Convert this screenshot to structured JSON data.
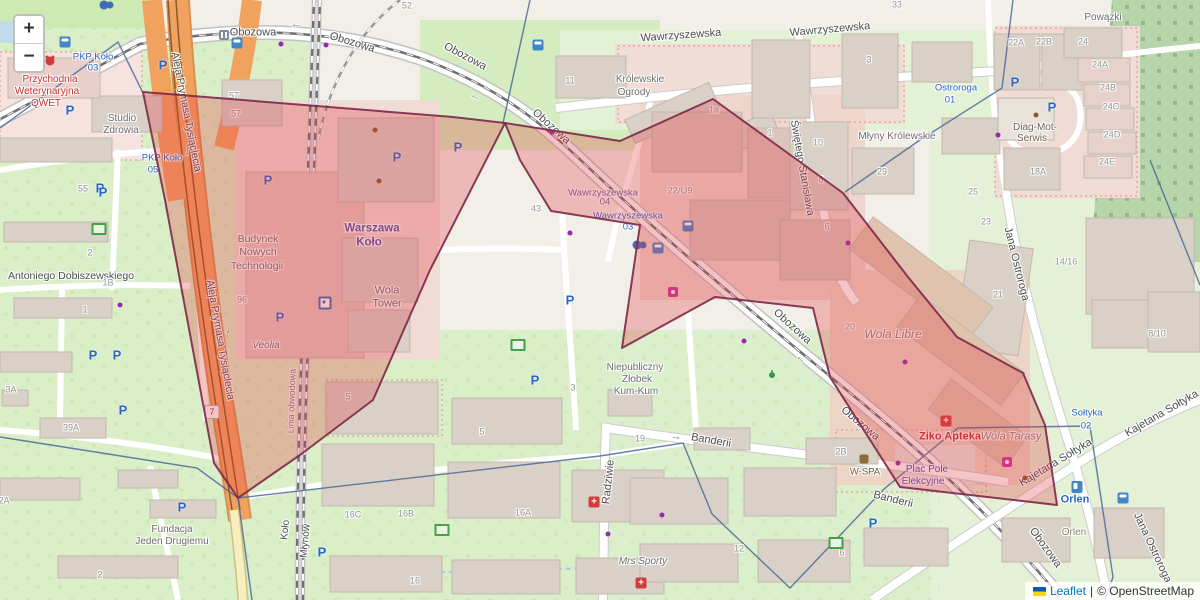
{
  "controls": {
    "zoom_in": "+",
    "zoom_out": "−"
  },
  "attribution": {
    "leaflet": "Leaflet",
    "sep": "|",
    "osm": "© OpenStreetMap"
  },
  "badge": {
    "t": "7",
    "x": 212,
    "y": 412
  },
  "overlay": {
    "fill": "#e23b42",
    "fill_opacity": 0.3,
    "stroke": "#7c2848",
    "stroke_width": 2,
    "stroke_opacity": 0.9,
    "polygons": [
      [
        [
          143,
          92
        ],
        [
          453,
          117
        ],
        [
          505,
          123
        ],
        [
          430,
          270
        ],
        [
          373,
          400
        ],
        [
          300,
          455
        ],
        [
          238,
          498
        ],
        [
          214,
          463
        ],
        [
          165,
          200
        ]
      ],
      [
        [
          505,
          123
        ],
        [
          620,
          141
        ],
        [
          713,
          99
        ],
        [
          843,
          193
        ],
        [
          908,
          277
        ],
        [
          957,
          337
        ],
        [
          1023,
          373
        ],
        [
          1045,
          425
        ],
        [
          1057,
          505
        ],
        [
          900,
          487
        ],
        [
          830,
          377
        ],
        [
          813,
          308
        ],
        [
          715,
          297
        ],
        [
          622,
          348
        ],
        [
          640,
          225
        ],
        [
          551,
          211
        ],
        [
          520,
          160
        ]
      ]
    ]
  },
  "admin_lines": {
    "color": "#4a6896",
    "width": 1.4,
    "paths": [
      [
        [
          0,
          128
        ],
        [
          118,
          42
        ],
        [
          143,
          93
        ]
      ],
      [
        [
          530,
          0
        ],
        [
          503,
          123
        ]
      ],
      [
        [
          0,
          437
        ],
        [
          197,
          468
        ],
        [
          238,
          498
        ],
        [
          600,
          456
        ],
        [
          683,
          443
        ],
        [
          712,
          514
        ],
        [
          790,
          588
        ],
        [
          884,
          489
        ],
        [
          958,
          428
        ],
        [
          1090,
          426
        ],
        [
          1113,
          577
        ],
        [
          1105,
          600
        ]
      ],
      [
        [
          238,
          498
        ],
        [
          252,
          600
        ]
      ],
      [
        [
          1013,
          0
        ],
        [
          1002,
          88
        ],
        [
          920,
          140
        ],
        [
          845,
          192
        ]
      ],
      [
        [
          1150,
          160
        ],
        [
          1200,
          285
        ]
      ]
    ]
  },
  "labels": [
    {
      "k": "st",
      "t": "Obozowa",
      "x": 253,
      "y": 33,
      "r": 0
    },
    {
      "k": "st",
      "t": "Obozowa",
      "x": 352,
      "y": 43,
      "r": 17
    },
    {
      "k": "st",
      "t": "Obozowa",
      "x": 465,
      "y": 57,
      "r": 28
    },
    {
      "k": "st",
      "t": "Obozowa",
      "x": 551,
      "y": 127,
      "r": 42
    },
    {
      "k": "st",
      "t": "Obozowa",
      "x": 792,
      "y": 327,
      "r": 42
    },
    {
      "k": "st",
      "t": "Obozowa",
      "x": 860,
      "y": 424,
      "r": 40
    },
    {
      "k": "st",
      "t": "Obozowa",
      "x": 1045,
      "y": 548,
      "r": 54
    },
    {
      "k": "st",
      "t": "Wawrzyszewska",
      "x": 681,
      "y": 36,
      "r": -4
    },
    {
      "k": "st",
      "t": "Wawrzyszewska",
      "x": 830,
      "y": 30,
      "r": -5
    },
    {
      "k": "st",
      "t": "Świętego Stanisława",
      "x": 802,
      "y": 168,
      "r": 80,
      "s": 10.5
    },
    {
      "k": "st",
      "t": "Jana Ostroroga",
      "x": 1016,
      "y": 264,
      "r": 76
    },
    {
      "k": "st",
      "t": "Jana Ostroroga",
      "x": 1152,
      "y": 548,
      "r": 65
    },
    {
      "k": "st",
      "t": "Aleja Prymasa Tysiąclecia",
      "x": 186,
      "y": 112,
      "r": 79,
      "s": 10.5
    },
    {
      "k": "st",
      "t": "Aleja Prymasa Tysiąclecia",
      "x": 220,
      "y": 340,
      "r": 80,
      "s": 10.5
    },
    {
      "k": "st",
      "t": "Kajetana Sołtyka",
      "x": 1056,
      "y": 463,
      "r": -31
    },
    {
      "k": "st",
      "t": "Kajetana Sołtyka",
      "x": 1162,
      "y": 414,
      "r": -30
    },
    {
      "k": "st",
      "t": "Banderii",
      "x": 711,
      "y": 441,
      "r": 10
    },
    {
      "k": "st",
      "t": "Banderii",
      "x": 893,
      "y": 500,
      "r": 14
    },
    {
      "k": "st",
      "t": "Radziwie",
      "x": 609,
      "y": 482,
      "r": -84
    },
    {
      "k": "st",
      "t": "Antoniego Dobiszewskiego",
      "x": 71,
      "y": 276,
      "r": 0,
      "s": 10.5
    },
    {
      "k": "st",
      "t": "Młynów",
      "x": 306,
      "y": 541,
      "r": -84,
      "s": 10
    },
    {
      "k": "st",
      "t": "Koło",
      "x": 286,
      "y": 530,
      "r": -84,
      "s": 10
    },
    {
      "k": "st",
      "t": "Linia obwodowa",
      "x": 292,
      "y": 401,
      "r": -88,
      "s": 9,
      "c": "#808080"
    },
    {
      "k": "arw",
      "t": "→",
      "x": 296,
      "y": 26,
      "r": 180
    },
    {
      "k": "arw",
      "t": "→",
      "x": 475,
      "y": 98,
      "r": 208
    },
    {
      "k": "arw",
      "t": "→",
      "x": 800,
      "y": 360,
      "r": 222
    },
    {
      "k": "arw",
      "t": "→",
      "x": 1042,
      "y": 532,
      "r": 233
    },
    {
      "k": "arw",
      "t": "→",
      "x": 676,
      "y": 437,
      "r": 8
    },
    {
      "k": "arw",
      "t": "→",
      "x": 188,
      "y": 152,
      "r": 95
    },
    {
      "k": "arw",
      "t": "→",
      "x": 229,
      "y": 330,
      "r": 99
    },
    {
      "k": "poi",
      "t": "Przychodnia",
      "x": 50,
      "y": 80,
      "c": "#c03434"
    },
    {
      "k": "poi",
      "t": "Weterynaryjna",
      "x": 47,
      "y": 92,
      "c": "#c03434"
    },
    {
      "k": "poi",
      "t": "QWET",
      "x": 46,
      "y": 104,
      "c": "#c03434"
    },
    {
      "k": "poi",
      "t": "Studio",
      "x": 122,
      "y": 119
    },
    {
      "k": "poi",
      "t": "Zdrowia",
      "x": 121,
      "y": 131
    },
    {
      "k": "poi",
      "t": "Budynek",
      "x": 258,
      "y": 239,
      "s": 10.5
    },
    {
      "k": "poi",
      "t": "Nowych",
      "x": 258,
      "y": 252,
      "s": 10.5
    },
    {
      "k": "poi",
      "t": "Technologii",
      "x": 257,
      "y": 266,
      "s": 10.5
    },
    {
      "k": "poi",
      "t": "Wola",
      "x": 387,
      "y": 291,
      "s": 11
    },
    {
      "k": "poi",
      "t": "Tower",
      "x": 387,
      "y": 304,
      "s": 11
    },
    {
      "k": "poi",
      "t": "Veolia",
      "x": 266,
      "y": 346,
      "i": 1
    },
    {
      "k": "poi",
      "t": "Warszawa",
      "x": 372,
      "y": 229,
      "c": "#5055a8",
      "b": 1,
      "s": 11.5,
      "n": "station-label"
    },
    {
      "k": "poi",
      "t": "Koło",
      "x": 369,
      "y": 243,
      "c": "#5055a8",
      "b": 1,
      "s": 11.5,
      "n": "station-label"
    },
    {
      "k": "poi",
      "t": "Królewskie",
      "x": 640,
      "y": 80
    },
    {
      "k": "poi",
      "t": "Ogrody",
      "x": 634,
      "y": 93
    },
    {
      "k": "poi",
      "t": "Młyny Królewskie",
      "x": 897,
      "y": 137
    },
    {
      "k": "poi",
      "t": "Niepubliczny",
      "x": 635,
      "y": 368
    },
    {
      "k": "poi",
      "t": "Żłobek",
      "x": 637,
      "y": 380
    },
    {
      "k": "poi",
      "t": "Kum-Kum",
      "x": 636,
      "y": 392
    },
    {
      "k": "poi",
      "t": "Mrs Sporty",
      "x": 643,
      "y": 562,
      "i": 1
    },
    {
      "k": "poi",
      "t": "Fundacja",
      "x": 172,
      "y": 530
    },
    {
      "k": "poi",
      "t": "Jeden Drugiemu",
      "x": 172,
      "y": 542
    },
    {
      "k": "poi",
      "t": "Wola Libre",
      "x": 893,
      "y": 334,
      "i": 1,
      "s": 12,
      "c": "#8d8478"
    },
    {
      "k": "poi",
      "t": "Wola Tarasy",
      "x": 1011,
      "y": 437,
      "i": 1,
      "s": 11,
      "c": "#8d8478"
    },
    {
      "k": "poi",
      "t": "Diag-Mot-",
      "x": 1035,
      "y": 128,
      "c": "#6e6456"
    },
    {
      "k": "poi",
      "t": "Serwis",
      "x": 1032,
      "y": 139,
      "c": "#6e6456"
    },
    {
      "k": "poi",
      "t": "Powązki",
      "x": 1103,
      "y": 18
    },
    {
      "k": "poi",
      "t": "Ziko Apteka",
      "x": 950,
      "y": 437,
      "c": "#cc2f2f",
      "b": 1,
      "s": 11,
      "n": "pharmacy-label"
    },
    {
      "k": "poi",
      "t": "Plac Pole",
      "x": 927,
      "y": 470,
      "c": "#4a50c0"
    },
    {
      "k": "poi",
      "t": "Elekcyjne",
      "x": 923,
      "y": 482,
      "c": "#4a50c0"
    },
    {
      "k": "poi",
      "t": "W-SPA",
      "x": 865,
      "y": 472,
      "c": "#6c5a42",
      "s": 9.5
    },
    {
      "k": "poi",
      "t": "Orlen",
      "x": 1075,
      "y": 500,
      "c": "#2a66c4",
      "b": 1,
      "s": 11
    },
    {
      "k": "poi",
      "t": "Orlen",
      "x": 1074,
      "y": 533,
      "c": "#8d8478"
    },
    {
      "k": "tr",
      "t": "PKP Koło",
      "x": 93,
      "y": 57
    },
    {
      "k": "tr",
      "t": "03",
      "x": 93,
      "y": 68
    },
    {
      "k": "tr",
      "t": "PKP Koło",
      "x": 162,
      "y": 158
    },
    {
      "k": "tr",
      "t": "05",
      "x": 153,
      "y": 170
    },
    {
      "k": "tr",
      "t": "Wawrzyszewska",
      "x": 603,
      "y": 193,
      "c": "#6a5f9e"
    },
    {
      "k": "tr",
      "t": "04",
      "x": 605,
      "y": 202,
      "c": "#6a5f9e"
    },
    {
      "k": "tr",
      "t": "Wawrzyszewska",
      "x": 628,
      "y": 216
    },
    {
      "k": "tr",
      "t": "03",
      "x": 628,
      "y": 227
    },
    {
      "k": "tr",
      "t": "Ostroroga",
      "x": 956,
      "y": 88
    },
    {
      "k": "tr",
      "t": "01",
      "x": 950,
      "y": 100
    },
    {
      "k": "tr",
      "t": "Sołtyka",
      "x": 1087,
      "y": 413
    },
    {
      "k": "tr",
      "t": "02",
      "x": 1086,
      "y": 426
    },
    {
      "k": "num",
      "t": "52",
      "x": 407,
      "y": 6
    },
    {
      "k": "num",
      "t": "57",
      "x": 234,
      "y": 96
    },
    {
      "k": "num",
      "t": "57",
      "x": 236,
      "y": 114
    },
    {
      "k": "num",
      "t": "55",
      "x": 83,
      "y": 189
    },
    {
      "k": "num",
      "t": "11",
      "x": 570,
      "y": 81
    },
    {
      "k": "num",
      "t": "96",
      "x": 242,
      "y": 300
    },
    {
      "k": "num",
      "t": "43",
      "x": 536,
      "y": 209
    },
    {
      "k": "num",
      "t": "22/U9",
      "x": 680,
      "y": 191,
      "s": 9.5
    },
    {
      "k": "num",
      "t": "1a",
      "x": 714,
      "y": 110
    },
    {
      "k": "num",
      "t": "1",
      "x": 770,
      "y": 133
    },
    {
      "k": "num",
      "t": "3",
      "x": 869,
      "y": 60
    },
    {
      "k": "num",
      "t": "10",
      "x": 818,
      "y": 143
    },
    {
      "k": "num",
      "t": "8",
      "x": 821,
      "y": 180
    },
    {
      "k": "num",
      "t": "29",
      "x": 882,
      "y": 172
    },
    {
      "k": "num",
      "t": "33",
      "x": 897,
      "y": 5
    },
    {
      "k": "num",
      "t": "25",
      "x": 973,
      "y": 192
    },
    {
      "k": "num",
      "t": "22A",
      "x": 1016,
      "y": 43
    },
    {
      "k": "num",
      "t": "22B",
      "x": 1044,
      "y": 42
    },
    {
      "k": "num",
      "t": "24",
      "x": 1083,
      "y": 42
    },
    {
      "k": "num",
      "t": "24A",
      "x": 1100,
      "y": 65
    },
    {
      "k": "num",
      "t": "24B",
      "x": 1108,
      "y": 88
    },
    {
      "k": "num",
      "t": "24C",
      "x": 1111,
      "y": 107
    },
    {
      "k": "num",
      "t": "24D",
      "x": 1112,
      "y": 135
    },
    {
      "k": "num",
      "t": "24E",
      "x": 1107,
      "y": 162
    },
    {
      "k": "num",
      "t": "18A",
      "x": 1038,
      "y": 172
    },
    {
      "k": "num",
      "t": "14/16",
      "x": 1066,
      "y": 262
    },
    {
      "k": "num",
      "t": "21",
      "x": 998,
      "y": 295
    },
    {
      "k": "num",
      "t": "23",
      "x": 986,
      "y": 222
    },
    {
      "k": "num",
      "t": "8/10",
      "x": 1157,
      "y": 334
    },
    {
      "k": "num",
      "t": "20",
      "x": 850,
      "y": 327
    },
    {
      "k": "num",
      "t": "6",
      "x": 827,
      "y": 227
    },
    {
      "k": "num",
      "t": "2B",
      "x": 841,
      "y": 452
    },
    {
      "k": "num",
      "t": "19",
      "x": 640,
      "y": 439
    },
    {
      "k": "num",
      "t": "12",
      "x": 739,
      "y": 549
    },
    {
      "k": "num",
      "t": "6",
      "x": 842,
      "y": 553
    },
    {
      "k": "num",
      "t": "16C",
      "x": 353,
      "y": 515
    },
    {
      "k": "num",
      "t": "16B",
      "x": 406,
      "y": 514
    },
    {
      "k": "num",
      "t": "16A",
      "x": 523,
      "y": 513
    },
    {
      "k": "num",
      "t": "16",
      "x": 415,
      "y": 581
    },
    {
      "k": "num",
      "t": "5",
      "x": 348,
      "y": 397
    },
    {
      "k": "num",
      "t": "5",
      "x": 482,
      "y": 432
    },
    {
      "k": "num",
      "t": "3",
      "x": 573,
      "y": 388
    },
    {
      "k": "num",
      "t": "2",
      "x": 90,
      "y": 253
    },
    {
      "k": "num",
      "t": "1B",
      "x": 108,
      "y": 283
    },
    {
      "k": "num",
      "t": "1",
      "x": 85,
      "y": 310
    },
    {
      "k": "num",
      "t": "3A",
      "x": 11,
      "y": 390
    },
    {
      "k": "num",
      "t": "39A",
      "x": 71,
      "y": 428
    },
    {
      "k": "num",
      "t": "2A",
      "x": 4,
      "y": 501
    },
    {
      "k": "num",
      "t": "2",
      "x": 100,
      "y": 575
    }
  ],
  "icons": [
    {
      "type": "parking",
      "x": 70,
      "y": 110
    },
    {
      "type": "parking",
      "x": 100,
      "y": 188
    },
    {
      "type": "parking",
      "x": 163,
      "y": 65
    },
    {
      "type": "parking",
      "x": 103,
      "y": 192
    },
    {
      "type": "parking",
      "x": 93,
      "y": 355
    },
    {
      "type": "parking",
      "x": 117,
      "y": 355
    },
    {
      "type": "parking",
      "x": 123,
      "y": 410
    },
    {
      "type": "parking",
      "x": 182,
      "y": 507
    },
    {
      "type": "parking",
      "x": 268,
      "y": 180
    },
    {
      "type": "parking",
      "x": 280,
      "y": 317
    },
    {
      "type": "parking",
      "x": 397,
      "y": 157
    },
    {
      "type": "parking",
      "x": 458,
      "y": 147
    },
    {
      "type": "parking",
      "x": 535,
      "y": 380
    },
    {
      "type": "parking",
      "x": 570,
      "y": 300
    },
    {
      "type": "parking",
      "x": 322,
      "y": 552
    },
    {
      "type": "parking",
      "x": 873,
      "y": 523
    },
    {
      "type": "parking",
      "x": 1015,
      "y": 82
    },
    {
      "type": "parking",
      "x": 1052,
      "y": 107
    },
    {
      "type": "bus-stop",
      "x": 65,
      "y": 42
    },
    {
      "type": "bus-stop",
      "x": 237,
      "y": 43
    },
    {
      "type": "bus-stop",
      "x": 538,
      "y": 45
    },
    {
      "type": "bus-stop",
      "x": 658,
      "y": 248
    },
    {
      "type": "bus-stop",
      "x": 688,
      "y": 226
    },
    {
      "type": "bus-stop",
      "x": 1123,
      "y": 498
    },
    {
      "type": "tram-stop",
      "x": 224,
      "y": 35
    },
    {
      "type": "rail-station",
      "x": 325,
      "y": 303
    },
    {
      "type": "bike",
      "x": 637,
      "y": 245
    },
    {
      "type": "bike",
      "x": 104,
      "y": 5
    },
    {
      "type": "pharmacy",
      "x": 946,
      "y": 421
    },
    {
      "type": "pharmacy",
      "x": 594,
      "y": 502
    },
    {
      "type": "pharmacy",
      "x": 641,
      "y": 583
    },
    {
      "type": "cart",
      "x": 673,
      "y": 292
    },
    {
      "type": "cart",
      "x": 1007,
      "y": 462
    },
    {
      "type": "fuel",
      "x": 1077,
      "y": 487
    },
    {
      "type": "vet",
      "x": 50,
      "y": 61
    },
    {
      "type": "spa",
      "x": 864,
      "y": 459
    },
    {
      "type": "poi-dot",
      "x": 375,
      "y": 130,
      "c": "#8a5a28"
    },
    {
      "type": "poi-dot",
      "x": 379,
      "y": 181,
      "c": "#8a5a28"
    },
    {
      "type": "poi-dot",
      "x": 1036,
      "y": 115,
      "c": "#8a5a28"
    },
    {
      "type": "poi-dot",
      "x": 1025,
      "y": 478,
      "c": "#8a5a28"
    },
    {
      "type": "playground",
      "x": 99,
      "y": 229
    },
    {
      "type": "playground",
      "x": 518,
      "y": 345
    },
    {
      "type": "playground",
      "x": 442,
      "y": 530
    },
    {
      "type": "playground",
      "x": 836,
      "y": 543
    },
    {
      "type": "runner",
      "x": 772,
      "y": 375
    },
    {
      "type": "poi-dot",
      "x": 281,
      "y": 44,
      "c": "#9c27b0"
    },
    {
      "type": "poi-dot",
      "x": 326,
      "y": 45,
      "c": "#9c27b0"
    },
    {
      "type": "poi-dot",
      "x": 744,
      "y": 341,
      "c": "#9c27b0"
    },
    {
      "type": "poi-dot",
      "x": 570,
      "y": 233,
      "c": "#9c27b0"
    },
    {
      "type": "poi-dot",
      "x": 848,
      "y": 243,
      "c": "#9c27b0"
    },
    {
      "type": "poi-dot",
      "x": 905,
      "y": 362,
      "c": "#9c27b0"
    },
    {
      "type": "poi-dot",
      "x": 608,
      "y": 534,
      "c": "#9c27b0"
    },
    {
      "type": "poi-dot",
      "x": 662,
      "y": 515,
      "c": "#9c27b0"
    },
    {
      "type": "poi-dot",
      "x": 552,
      "y": 132,
      "c": "#9c27b0"
    },
    {
      "type": "poi-dot",
      "x": 998,
      "y": 135,
      "c": "#9c27b0"
    },
    {
      "type": "poi-dot",
      "x": 898,
      "y": 463,
      "c": "#9c27b0"
    },
    {
      "type": "poi-dot",
      "x": 120,
      "y": 305,
      "c": "#9c27b0"
    }
  ]
}
